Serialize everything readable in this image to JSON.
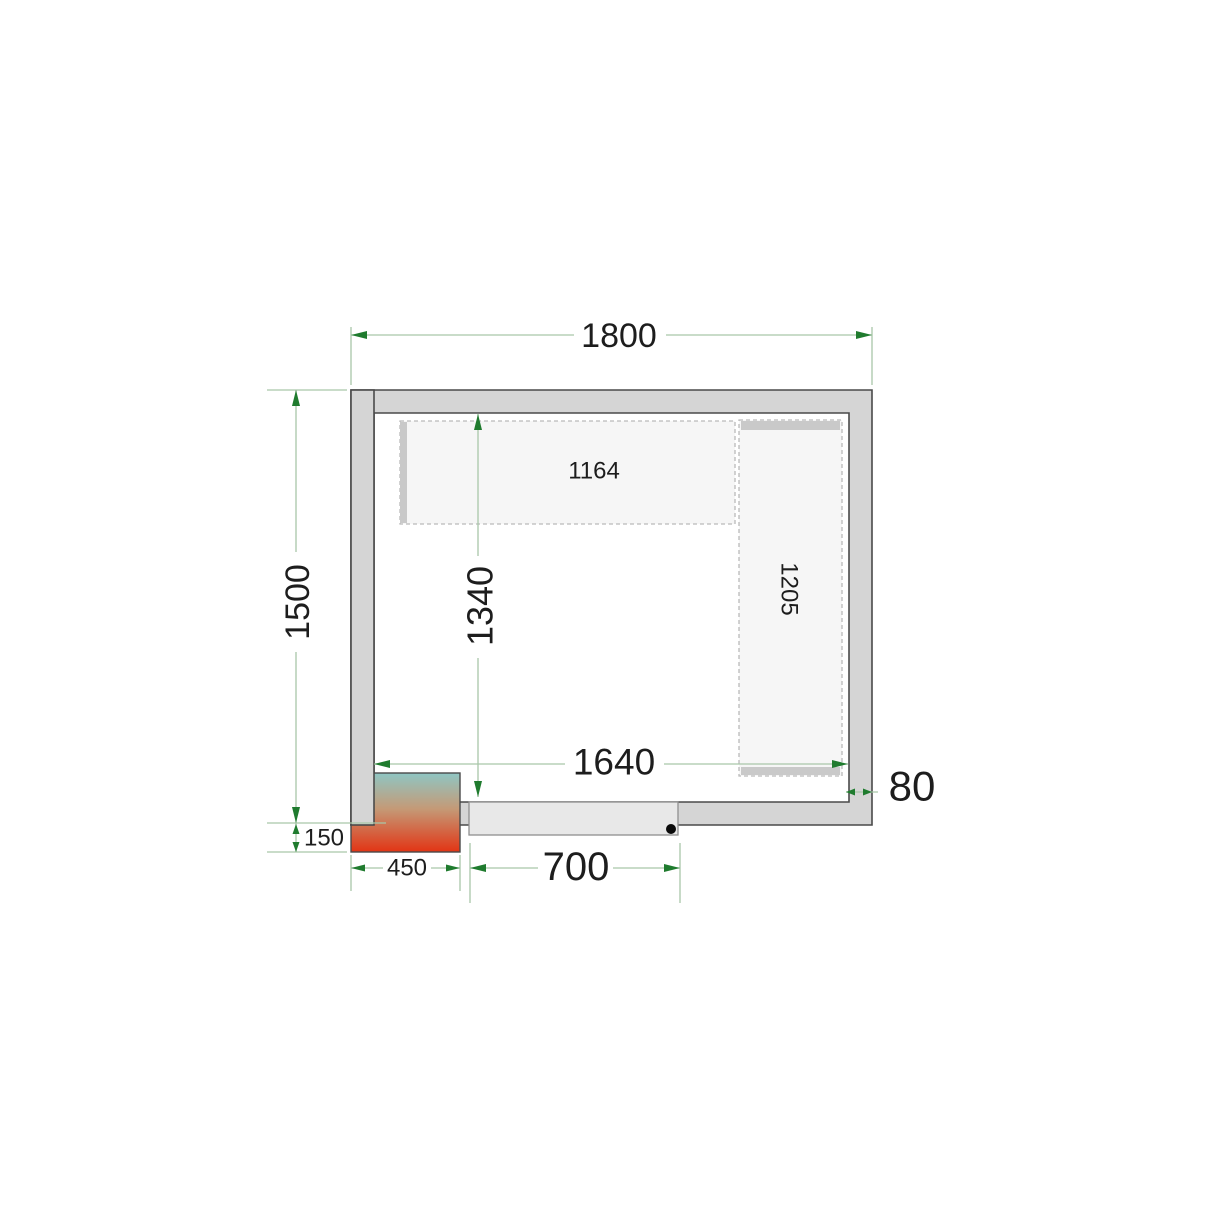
{
  "drawing": {
    "kind": "cold-room-floor-plan-top-view",
    "unit_of_measure": "mm"
  },
  "dims": {
    "outer_width": "1800",
    "outer_depth": "1500",
    "inner_width": "1640",
    "inner_depth": "1340",
    "wall_thickness": "80",
    "door_width": "700",
    "cooling_unit_width": "450",
    "cooling_unit_protrusion": "150",
    "top_shelf_length": "1164",
    "right_shelf_length": "1205"
  },
  "colors": {
    "wall_fill": "#d5d5d5",
    "wall_outline": "#4a4a4a",
    "shelf_fill": "#f6f6f6",
    "shelf_dash": "#bababa",
    "support_bar": "#c9c9c9",
    "door_fill": "#e8e8e8",
    "dimension_line": "#a9c7a9",
    "arrow_green": "#1f7b2e",
    "label_text": "#1d1d1d",
    "unit_gradient_top": "#8fc6c3",
    "unit_gradient_mid": "#c49a77",
    "unit_gradient_bottom": "#e23414"
  }
}
